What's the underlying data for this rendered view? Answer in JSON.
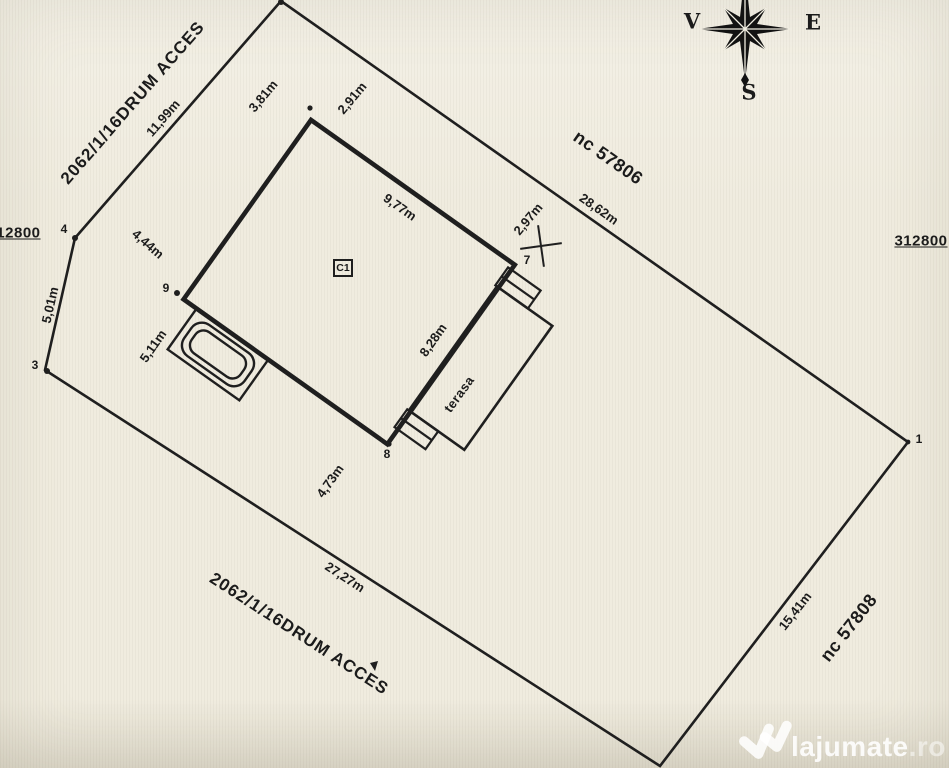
{
  "plan": {
    "road_label_top": "2062/1/16DRUM ACCES",
    "road_label_bottom": "2062/1/16DRUM ACCES",
    "neighbor_parcel_top": "nc 57806",
    "neighbor_parcel_right": "nc 57808",
    "grid_coord_left": "312800",
    "grid_coord_right": "312800",
    "building_label": "C1",
    "terrace_label": "terasa",
    "dims": {
      "seg_4_5": "11,99m",
      "setback_top_road": "3,81m",
      "setback_top_ne": "2,91m",
      "seg_5_1": "28,62m",
      "edge_6_7": "9,77m",
      "setback_right_ne": "2,97m",
      "edge_7_8": "8,28m",
      "setback_left_road": "4,44m",
      "seg_3_4": "5,01m",
      "setback_left_sw": "5,11m",
      "setback_bottom_sw": "4,73m",
      "seg_2_3": "27,27m",
      "seg_1_2": "15,41m"
    },
    "vertices": {
      "v1": "1",
      "v3": "3",
      "v4": "4",
      "v7": "7",
      "v8": "8",
      "v9": "9"
    },
    "compass": {
      "west": "V",
      "east": "E",
      "south": "S"
    },
    "watermark": {
      "brand": "lajumate",
      "tld": ".ro"
    }
  }
}
